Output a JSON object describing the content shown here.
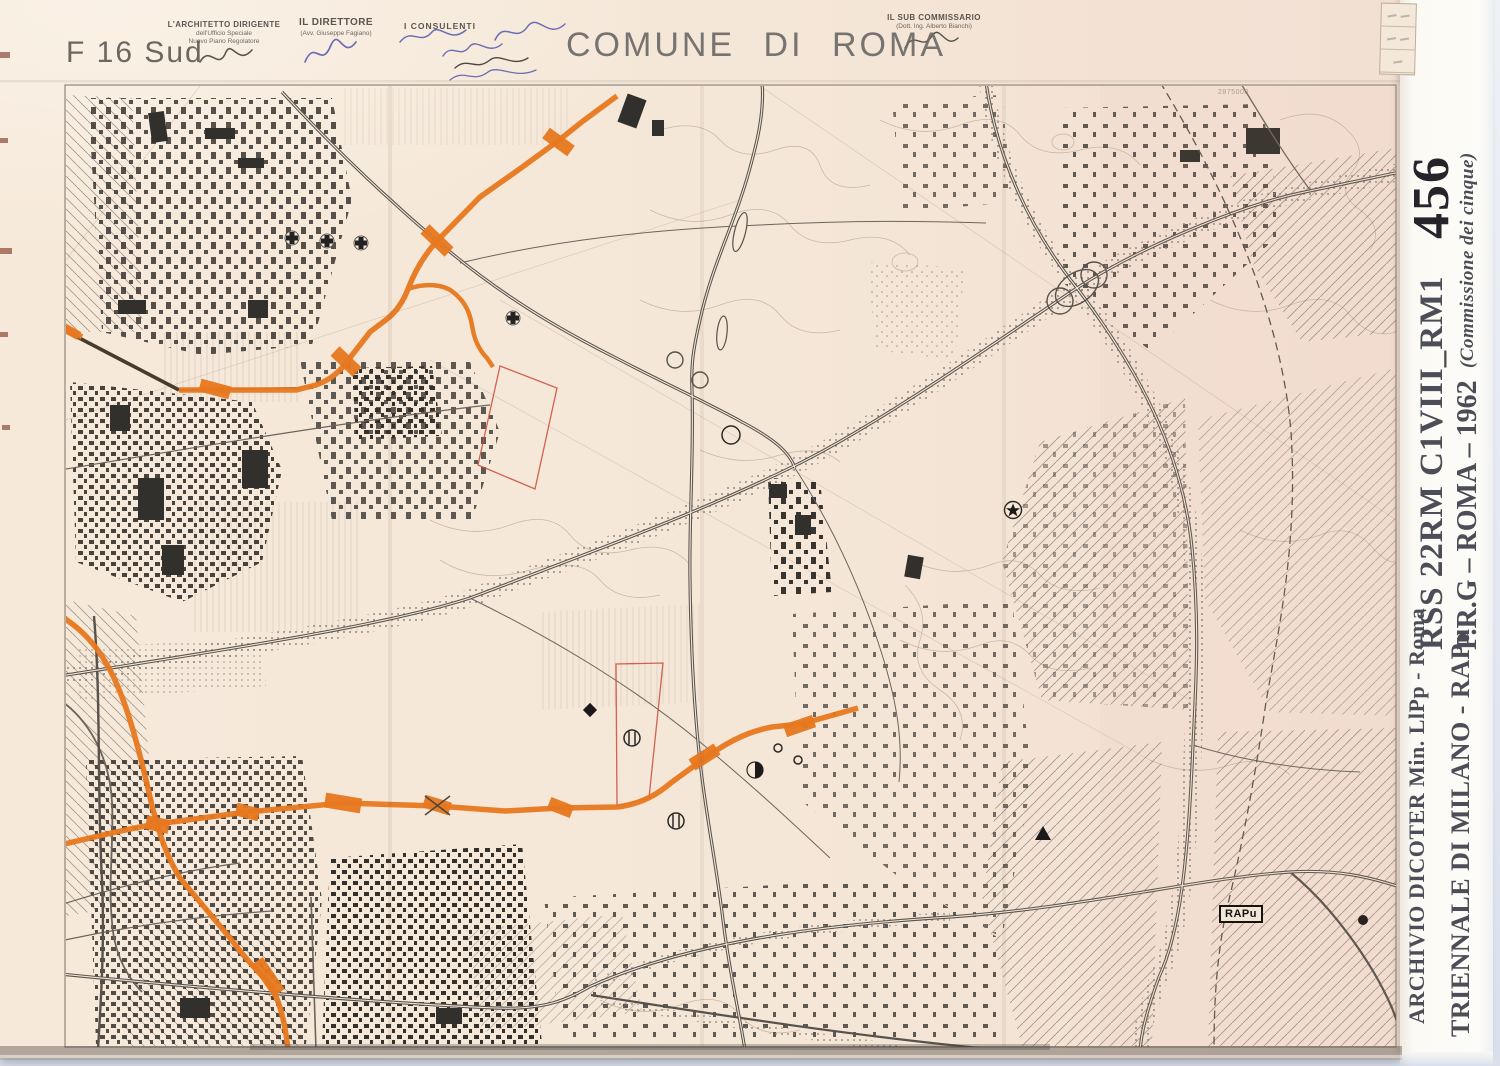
{
  "header": {
    "sheet_code": "F 16 Sud",
    "title": "COMUNE DI ROMA",
    "architect_title": "L'ARCHITETTO DIRIGENTE",
    "architect_line2": "dell'Ufficio Speciale",
    "architect_line3": "Nuovo Piano Regolatore",
    "director_title": "IL DIRETTORE",
    "director_line2": "(Avv. Giuseppe Fagiano)",
    "consultants_title": "I CONSULENTI",
    "subcommissioner_title": "IL SUB COMMISSARIO",
    "subcommissioner_line2": "(Dott. Ing. Alberto Bianchi)"
  },
  "map": {
    "stamp_label": "RAPu",
    "coord_label": "2875000"
  },
  "sidebar": {
    "catalog_code": "RSS 22RM C1VIII_RM1",
    "catalog_number": "456",
    "plan_label": "P.R.G – ROMA – 1962",
    "plan_note": "(Commissione dei cinque)",
    "archive_label": "ARCHIVIO DICOTER Min. LlPp - Roma",
    "collection_label": "TRIENNALE DI MILANO - RAPu"
  },
  "colors": {
    "paper": "#f5e8d9",
    "accent_orange": "#e8781f",
    "red_outline": "#c94a36",
    "line_gray": "#57524c",
    "building": "#35312d",
    "sidebar_text": "#4d4d57"
  }
}
